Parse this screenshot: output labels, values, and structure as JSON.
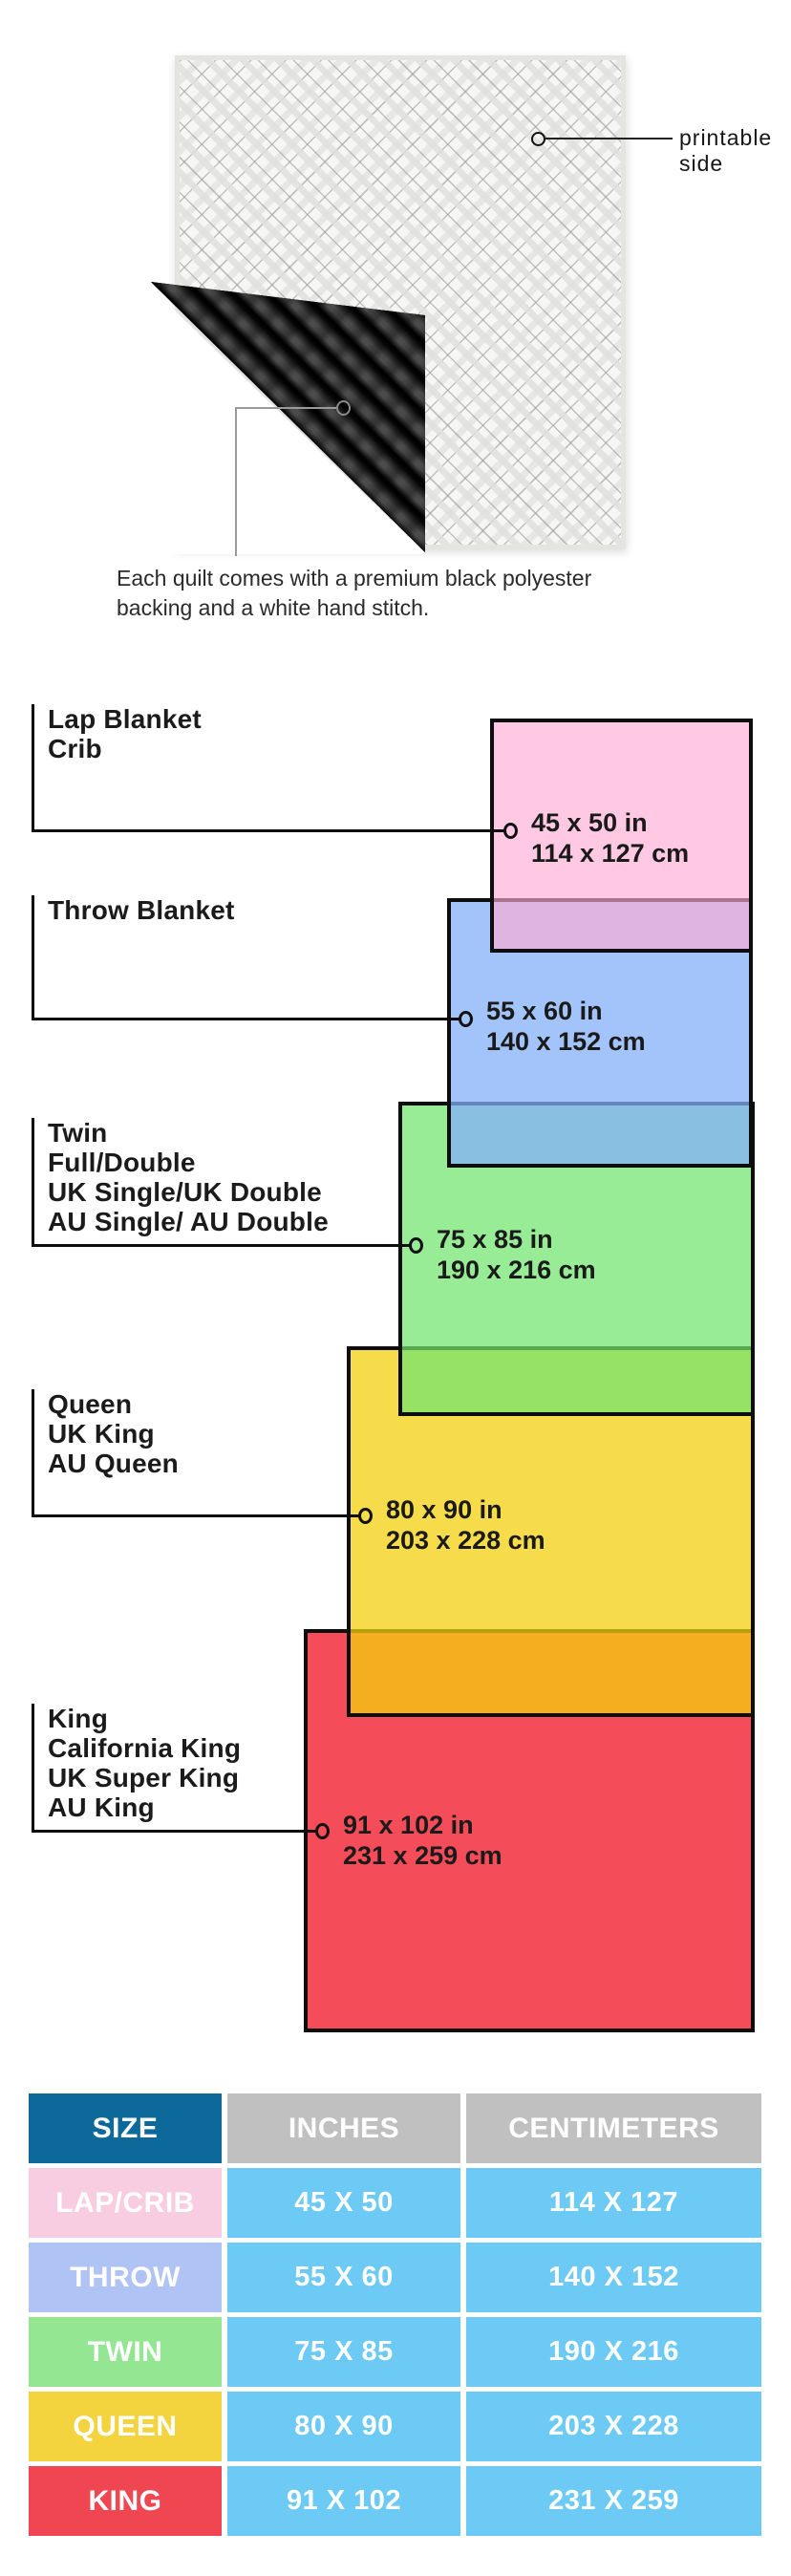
{
  "illustration": {
    "printable_callout": {
      "line1": "printable",
      "line2": "side"
    },
    "caption": {
      "line1": "Each quilt comes with a premium black polyester",
      "line2": "backing and a white hand stitch."
    },
    "front_color": "#f6f6f4",
    "backing_color": "#141414"
  },
  "diagram": {
    "sizes": [
      {
        "id": "lap",
        "names": [
          "Lap Blanket",
          "Crib"
        ],
        "inches": "45 x 50 in",
        "centimeters": "114 x 127 cm",
        "fill": "#FFC9E3"
      },
      {
        "id": "throw",
        "names": [
          "Throw Blanket"
        ],
        "inches": "55 x 60 in",
        "centimeters": "140 x 152 cm",
        "fill": "#A3C4FA"
      },
      {
        "id": "twin",
        "names": [
          "Twin",
          "Full/Double",
          "UK Single/UK Double",
          "AU Single/ AU Double"
        ],
        "inches": "75 x 85 in",
        "centimeters": "190 x 216 cm",
        "fill": "#98EC96"
      },
      {
        "id": "queen",
        "names": [
          "Queen",
          "UK King",
          "AU Queen"
        ],
        "inches": "80 x 90 in",
        "centimeters": "203 x 228 cm",
        "fill": "#F6DB4A"
      },
      {
        "id": "king",
        "names": [
          "King",
          "California King",
          "UK Super King",
          "AU King"
        ],
        "inches": "91 x 102 in",
        "centimeters": "231 x 259 cm",
        "fill": "#F54C5A"
      }
    ]
  },
  "table": {
    "headers": {
      "size": "SIZE",
      "inches": "INCHES",
      "centimeters": "CENTIMETERS"
    },
    "header_colors": {
      "size_bg": "#0E699B",
      "measure_bg": "#C0C0C0"
    },
    "value_cell_bg": "#6DCAF5",
    "rows": [
      {
        "size": "LAP/CRIB",
        "inches": "45 X 50",
        "centimeters": "114 X 127",
        "size_bg": "#F9CDE1"
      },
      {
        "size": "THROW",
        "inches": "55 X 60",
        "centimeters": "140 X 152",
        "size_bg": "#AFC3F4"
      },
      {
        "size": "TWIN",
        "inches": "75 X 85",
        "centimeters": "190 X 216",
        "size_bg": "#94E693"
      },
      {
        "size": "QUEEN",
        "inches": "80 X 90",
        "centimeters": "203 X 228",
        "size_bg": "#F3D33E"
      },
      {
        "size": "KING",
        "inches": "91 X 102",
        "centimeters": "231 X 259",
        "size_bg": "#F04652"
      }
    ]
  }
}
